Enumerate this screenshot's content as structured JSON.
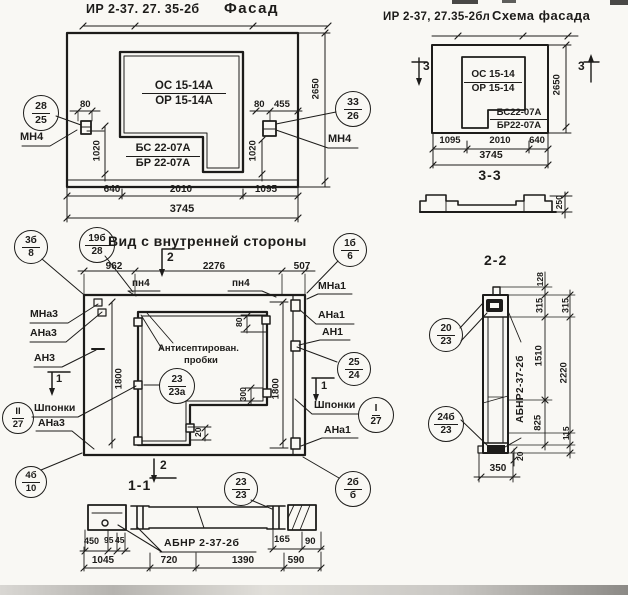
{
  "colors": {
    "ink": "#1d1c1a",
    "paper": "#f9f8f4"
  },
  "titles": {
    "facade_code": "ИР 2-37. 27. 35-2б",
    "facade_name": "Фасад",
    "schema_code": "ИР 2-37, 27.35-2бл",
    "schema_name": "Схема фасада",
    "inner_view": "Вид с внутренней стороны",
    "section_11": "1-1",
    "section_22": "2-2",
    "section_33": "3-3"
  },
  "facade": {
    "window_mark": {
      "num": "ОС 15-14А",
      "den": "ОР 15-14А"
    },
    "panel_mark": {
      "num": "БС 22-07А",
      "den": "БР 22-07А"
    },
    "anchor_left": "МН4",
    "anchor_right": "МН4",
    "dims": {
      "d80_left": "80",
      "d80_right": "80",
      "d455": "455",
      "d1020_left": "1020",
      "d1020_right": "1020",
      "d2650": "2650",
      "d640": "640",
      "d2010": "2010",
      "d1095": "1095",
      "d3745": "3745"
    },
    "bubble_left": {
      "top": "28",
      "bottom": "25"
    },
    "bubble_right": {
      "top": "33",
      "bottom": "26"
    }
  },
  "schema": {
    "window_mark": {
      "num": "ОС 15-14",
      "den": "ОР 15-14"
    },
    "panel_mark": {
      "num": "БС22-07А",
      "den": "БР22-07А"
    },
    "cut_mark_left": "3",
    "cut_mark_right": "3",
    "dims": {
      "d1095": "1095",
      "d2010": "2010",
      "d640": "640",
      "d3745": "3745",
      "d2650": "2650"
    }
  },
  "section33": {
    "dims": {
      "d250": "250"
    }
  },
  "inner": {
    "cut_mark_top": "2",
    "cut_mark_bottom": "2",
    "cut_mark_left": "1",
    "cut_mark_right": "1",
    "joint_left_top": "пн4",
    "joint_right_top": "пн4",
    "labels_left": {
      "mna3": "МНа3",
      "ana3": "АНа3",
      "an3": "АН3",
      "shponki": "Шпонки",
      "ana3_b": "АНа3"
    },
    "labels_right": {
      "mna1": "МНа1",
      "ana1": "АНа1",
      "an1": "АН1",
      "shponki": "Шпонки",
      "ana1_b": "АНа1"
    },
    "note_line1": "Антисептирован.",
    "note_line2": "пробки",
    "dims": {
      "d962": "962",
      "d2276": "2276",
      "d507": "507",
      "d1800_left": "1800",
      "d1800_right": "1800",
      "d300": "300",
      "d80": "80",
      "d20": "20"
    },
    "bubbles": {
      "b1": {
        "top": "3б",
        "bottom": "8"
      },
      "b2": {
        "top": "19б",
        "bottom": "28"
      },
      "b3": {
        "top": "1б",
        "bottom": "6"
      },
      "plugs": {
        "top": "23",
        "bottom": "23а"
      },
      "b25": {
        "top": "25",
        "bottom": "24"
      },
      "key_right": {
        "top": "I",
        "bottom": "27"
      },
      "key_left": {
        "top": "II",
        "bottom": "27"
      },
      "b4": {
        "top": "4б",
        "bottom": "10"
      },
      "b23": {
        "top": "23",
        "bottom": "23"
      },
      "b2b": {
        "top": "2б",
        "bottom": "б"
      }
    }
  },
  "section11": {
    "part_label": "АБНР 2-37-2б",
    "dims": {
      "d450": "450",
      "d95": "95",
      "d45": "45",
      "d165": "165",
      "d90": "90",
      "d1045": "1045",
      "d720": "720",
      "d1390": "1390",
      "d590": "590"
    }
  },
  "section22": {
    "part_label": "АБНР2-37-2б",
    "dims": {
      "d128": "128",
      "d315_a": "315",
      "d315_b": "315",
      "d1510": "1510",
      "d2220": "2220",
      "d825": "825",
      "d115": "115",
      "d20": "20",
      "d350": "350"
    },
    "bubbles": {
      "top": {
        "top": "20",
        "bottom": "23"
      },
      "bottom": {
        "top": "24б",
        "bottom": "23"
      }
    }
  }
}
